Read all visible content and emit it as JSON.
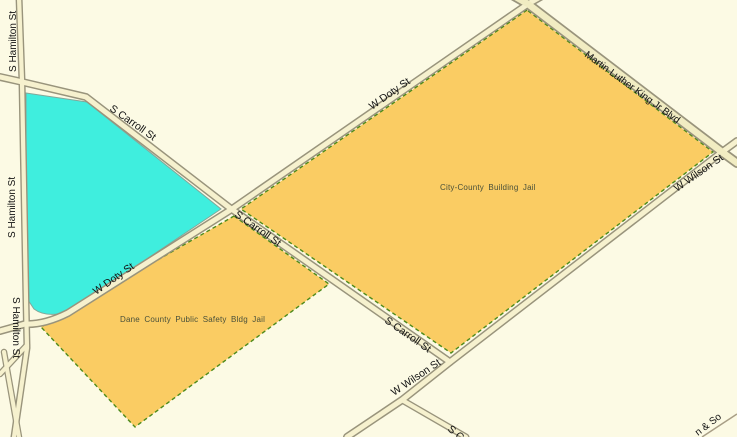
{
  "map": {
    "type": "gis-street-map",
    "colors": {
      "background": "#FCFAE4",
      "street_fill": "#F6F1CE",
      "street_casing": "#99947C",
      "major_street_fill": "#F1ECC2",
      "parcel_fill": "#FACC63",
      "parcel_border": "#4E8A1A",
      "highlight_parcel_fill": "#3FEEDE",
      "street_label": "#121212",
      "parcel_label": "#49503A"
    },
    "parcels": {
      "city_county_label": "City-County Building Jail",
      "dane_county_label": "Dane County Public Safety Bldg Jail"
    },
    "streets": {
      "s_hamilton": "S Hamilton St",
      "s_carroll": "S Carroll St",
      "w_doty": "W Doty St",
      "mlk_blvd": "Martin Luther King Jr Blvd",
      "w_wilson": "W Wilson St",
      "s_c_partial": "S C",
      "rail_partial": "n & So"
    }
  }
}
